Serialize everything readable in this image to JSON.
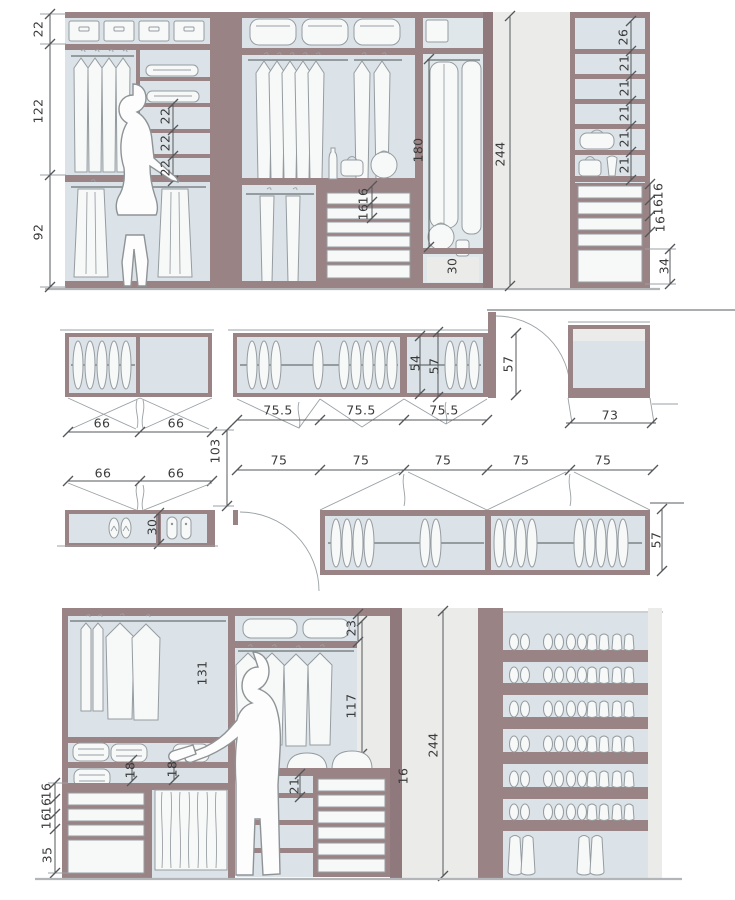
{
  "drawing": {
    "type": "walk-in-closet technical drawing",
    "views": [
      "top elevation",
      "plan views",
      "bottom elevation"
    ]
  },
  "colors": {
    "frame": "#9a8385",
    "interior": "#dbe3e8",
    "panel": "#ebebe9",
    "object": "#f7f8f8",
    "dimline": "#55575a",
    "text": "#3b3b3b",
    "floor": "#b3b6b8"
  },
  "sections": {
    "top_elevation": {
      "left_height_dims_cm": [
        22,
        122,
        92
      ],
      "inner_shelf_dims_cm": [
        22,
        22,
        22
      ],
      "center_drawer_dims_cm": [
        16,
        16
      ],
      "long_hanging_cm": 180,
      "base_compartment_cm": 30,
      "overall_height_cm": 244,
      "right_shelf_dims_cm": [
        26,
        21,
        21,
        21,
        21,
        21
      ],
      "right_drawer_dims_cm": [
        16,
        16,
        16,
        34
      ]
    },
    "plan_views": {
      "upper_left_door_widths_cm": [
        66,
        66
      ],
      "upper_center_door_widths_cm": [
        75.5,
        75.5,
        75.5
      ],
      "cabinet_depths_cm": [
        54,
        57,
        57,
        73
      ],
      "aisle_width_cm": 103,
      "lower_left_door_widths_cm": [
        66,
        66
      ],
      "shoe_cabinet_depth_cm": 30,
      "lower_door_widths_cm": [
        75,
        75,
        75,
        75,
        75
      ],
      "lower_cabinet_depth_cm": 57
    },
    "bottom_elevation": {
      "top_box_shelf_cm": 23,
      "rod_height_left_cm": 131,
      "rod_height_center_cm": 117,
      "overall_height_cm": 244,
      "sweater_shelf_dims_cm": [
        18,
        18
      ],
      "lower_shelf_cm": 21,
      "drawer_cm": 16,
      "left_drawer_dims_cm": [
        16,
        16,
        16,
        35
      ]
    }
  },
  "labels": [
    {
      "t": "22",
      "x": 38,
      "y": 29,
      "r": 1
    },
    {
      "t": "122",
      "x": 38,
      "y": 111,
      "r": 1
    },
    {
      "t": "92",
      "x": 38,
      "y": 232,
      "r": 1
    },
    {
      "t": "22",
      "x": 165,
      "y": 116,
      "r": 1
    },
    {
      "t": "22",
      "x": 165,
      "y": 143,
      "r": 1
    },
    {
      "t": "22",
      "x": 165,
      "y": 168,
      "r": 1
    },
    {
      "t": "16",
      "x": 363,
      "y": 196,
      "r": 1
    },
    {
      "t": "16",
      "x": 363,
      "y": 212,
      "r": 1
    },
    {
      "t": "180",
      "x": 418,
      "y": 150,
      "r": 1
    },
    {
      "t": "30",
      "x": 452,
      "y": 266,
      "r": 1
    },
    {
      "t": "244",
      "x": 500,
      "y": 154,
      "r": 1
    },
    {
      "t": "26",
      "x": 623,
      "y": 37,
      "r": 1
    },
    {
      "t": "21",
      "x": 624,
      "y": 63,
      "r": 1
    },
    {
      "t": "21",
      "x": 624,
      "y": 88,
      "r": 1
    },
    {
      "t": "21",
      "x": 624,
      "y": 113,
      "r": 1
    },
    {
      "t": "21",
      "x": 624,
      "y": 139,
      "r": 1
    },
    {
      "t": "21",
      "x": 624,
      "y": 165,
      "r": 1
    },
    {
      "t": "16",
      "x": 658,
      "y": 191,
      "r": 1
    },
    {
      "t": "16",
      "x": 658,
      "y": 207,
      "r": 1
    },
    {
      "t": "16",
      "x": 660,
      "y": 224,
      "r": 1
    },
    {
      "t": "34",
      "x": 664,
      "y": 266,
      "r": 1
    },
    {
      "t": "66",
      "x": 102,
      "y": 423
    },
    {
      "t": "66",
      "x": 176,
      "y": 423
    },
    {
      "t": "75.5",
      "x": 278,
      "y": 410
    },
    {
      "t": "75.5",
      "x": 361,
      "y": 410
    },
    {
      "t": "75.5",
      "x": 444,
      "y": 410
    },
    {
      "t": "54",
      "x": 415,
      "y": 363,
      "r": 1
    },
    {
      "t": "57",
      "x": 434,
      "y": 366,
      "r": 1
    },
    {
      "t": "57",
      "x": 508,
      "y": 364,
      "r": 1
    },
    {
      "t": "73",
      "x": 610,
      "y": 415
    },
    {
      "t": "103",
      "x": 215,
      "y": 451,
      "r": 1
    },
    {
      "t": "66",
      "x": 103,
      "y": 473
    },
    {
      "t": "66",
      "x": 176,
      "y": 473
    },
    {
      "t": "30",
      "x": 152,
      "y": 527,
      "r": 1
    },
    {
      "t": "75",
      "x": 279,
      "y": 460
    },
    {
      "t": "75",
      "x": 361,
      "y": 460
    },
    {
      "t": "75",
      "x": 443,
      "y": 460
    },
    {
      "t": "75",
      "x": 521,
      "y": 460
    },
    {
      "t": "75",
      "x": 603,
      "y": 460
    },
    {
      "t": "57",
      "x": 656,
      "y": 540,
      "r": 1
    },
    {
      "t": "23",
      "x": 351,
      "y": 628,
      "r": 1
    },
    {
      "t": "131",
      "x": 202,
      "y": 673,
      "r": 1
    },
    {
      "t": "117",
      "x": 351,
      "y": 706,
      "r": 1
    },
    {
      "t": "244",
      "x": 433,
      "y": 745,
      "r": 1
    },
    {
      "t": "18",
      "x": 130,
      "y": 770,
      "r": 1
    },
    {
      "t": "18",
      "x": 172,
      "y": 769,
      "r": 1
    },
    {
      "t": "21",
      "x": 294,
      "y": 786,
      "r": 1
    },
    {
      "t": "16",
      "x": 403,
      "y": 776,
      "r": 1
    },
    {
      "t": "16",
      "x": 46,
      "y": 791,
      "r": 1
    },
    {
      "t": "16",
      "x": 46,
      "y": 806,
      "r": 1
    },
    {
      "t": "16",
      "x": 46,
      "y": 821,
      "r": 1
    },
    {
      "t": "35",
      "x": 47,
      "y": 855,
      "r": 1
    }
  ]
}
